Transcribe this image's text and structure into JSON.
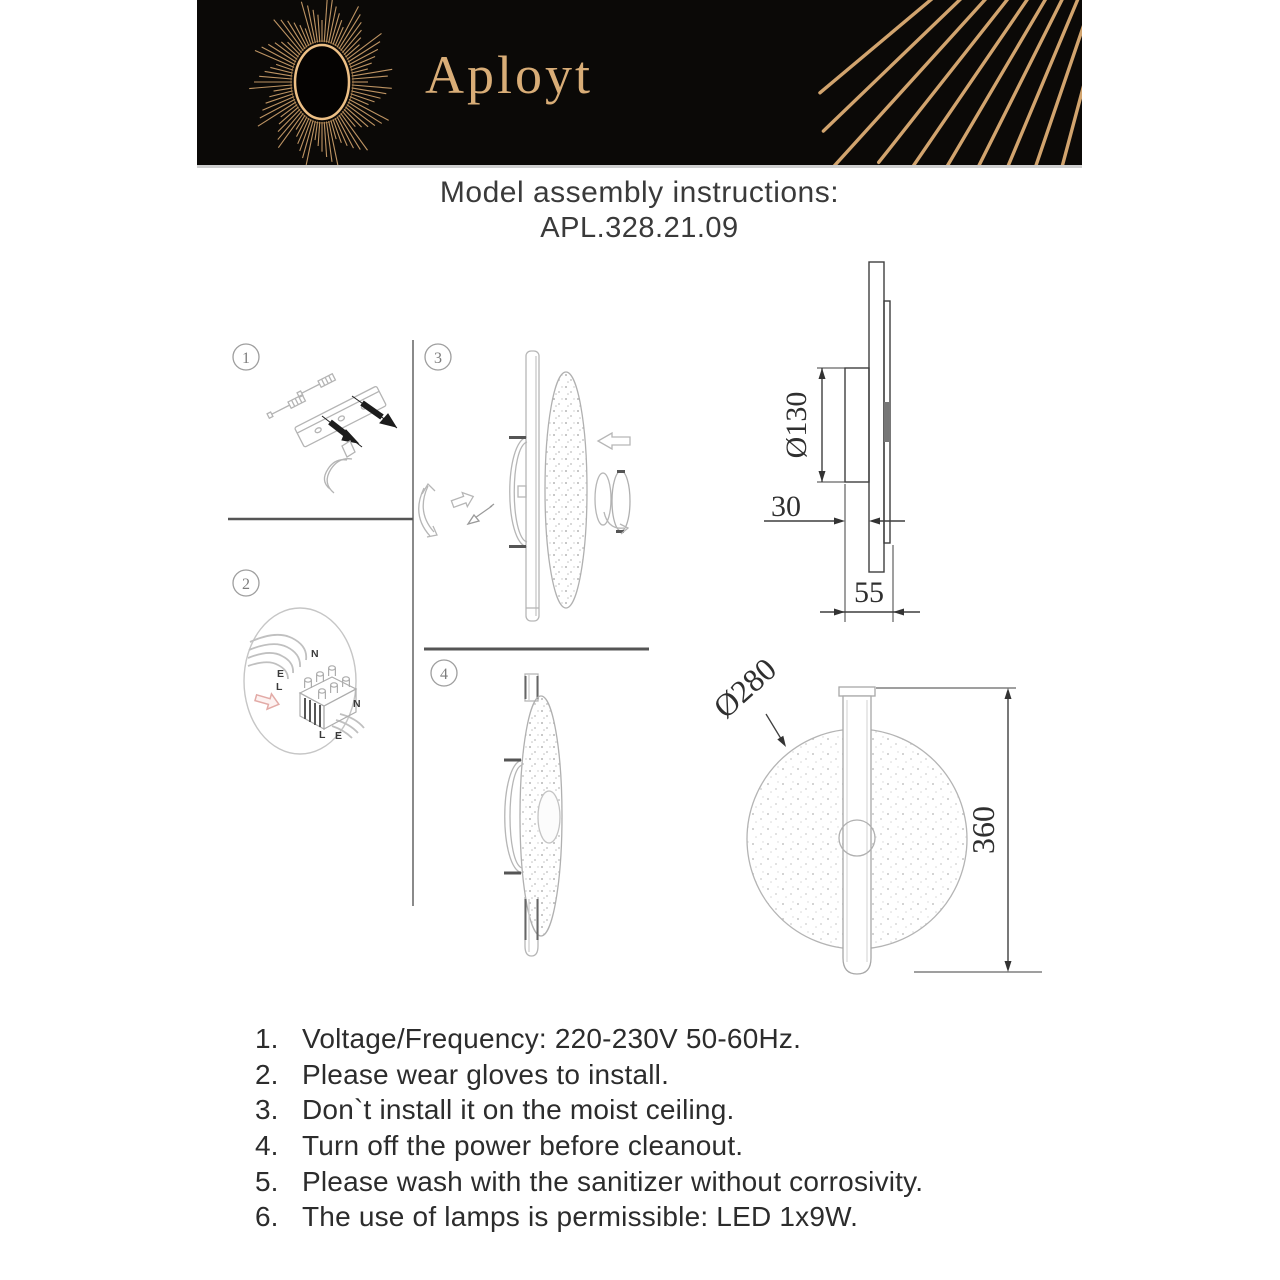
{
  "header": {
    "brand": "Aployt",
    "bg_color": "#0b0907",
    "accent_gold": "#d2a46e"
  },
  "title": {
    "line1": "Model assembly instructions:",
    "line2": "APL.328.21.09"
  },
  "steps": [
    {
      "num": "1"
    },
    {
      "num": "2"
    },
    {
      "num": "3"
    },
    {
      "num": "4"
    }
  ],
  "wiring": {
    "n_top": "N",
    "e_left": "E",
    "l_left": "L",
    "n_right": "N",
    "l_bottom": "L",
    "e_bottom": "E"
  },
  "dimensions": {
    "side_view": {
      "mount_diameter": "Ø130",
      "wall_offset": "30",
      "total_depth": "55"
    },
    "front_view": {
      "shade_diameter": "Ø280",
      "total_height": "360"
    }
  },
  "instructions": {
    "items": [
      {
        "num": "1.",
        "text": "Voltage/Frequency: 220-230V 50-60Hz."
      },
      {
        "num": "2.",
        "text": "Please wear gloves to install."
      },
      {
        "num": "3.",
        "text": "Don`t install it on the moist ceiling."
      },
      {
        "num": "4.",
        "text": "Turn off the power before cleanout."
      },
      {
        "num": "5.",
        "text": "Please wash with the sanitizer without corrosivity."
      },
      {
        "num": "6.",
        "text": "The use of lamps is permissible: LED 1x9W."
      }
    ]
  }
}
